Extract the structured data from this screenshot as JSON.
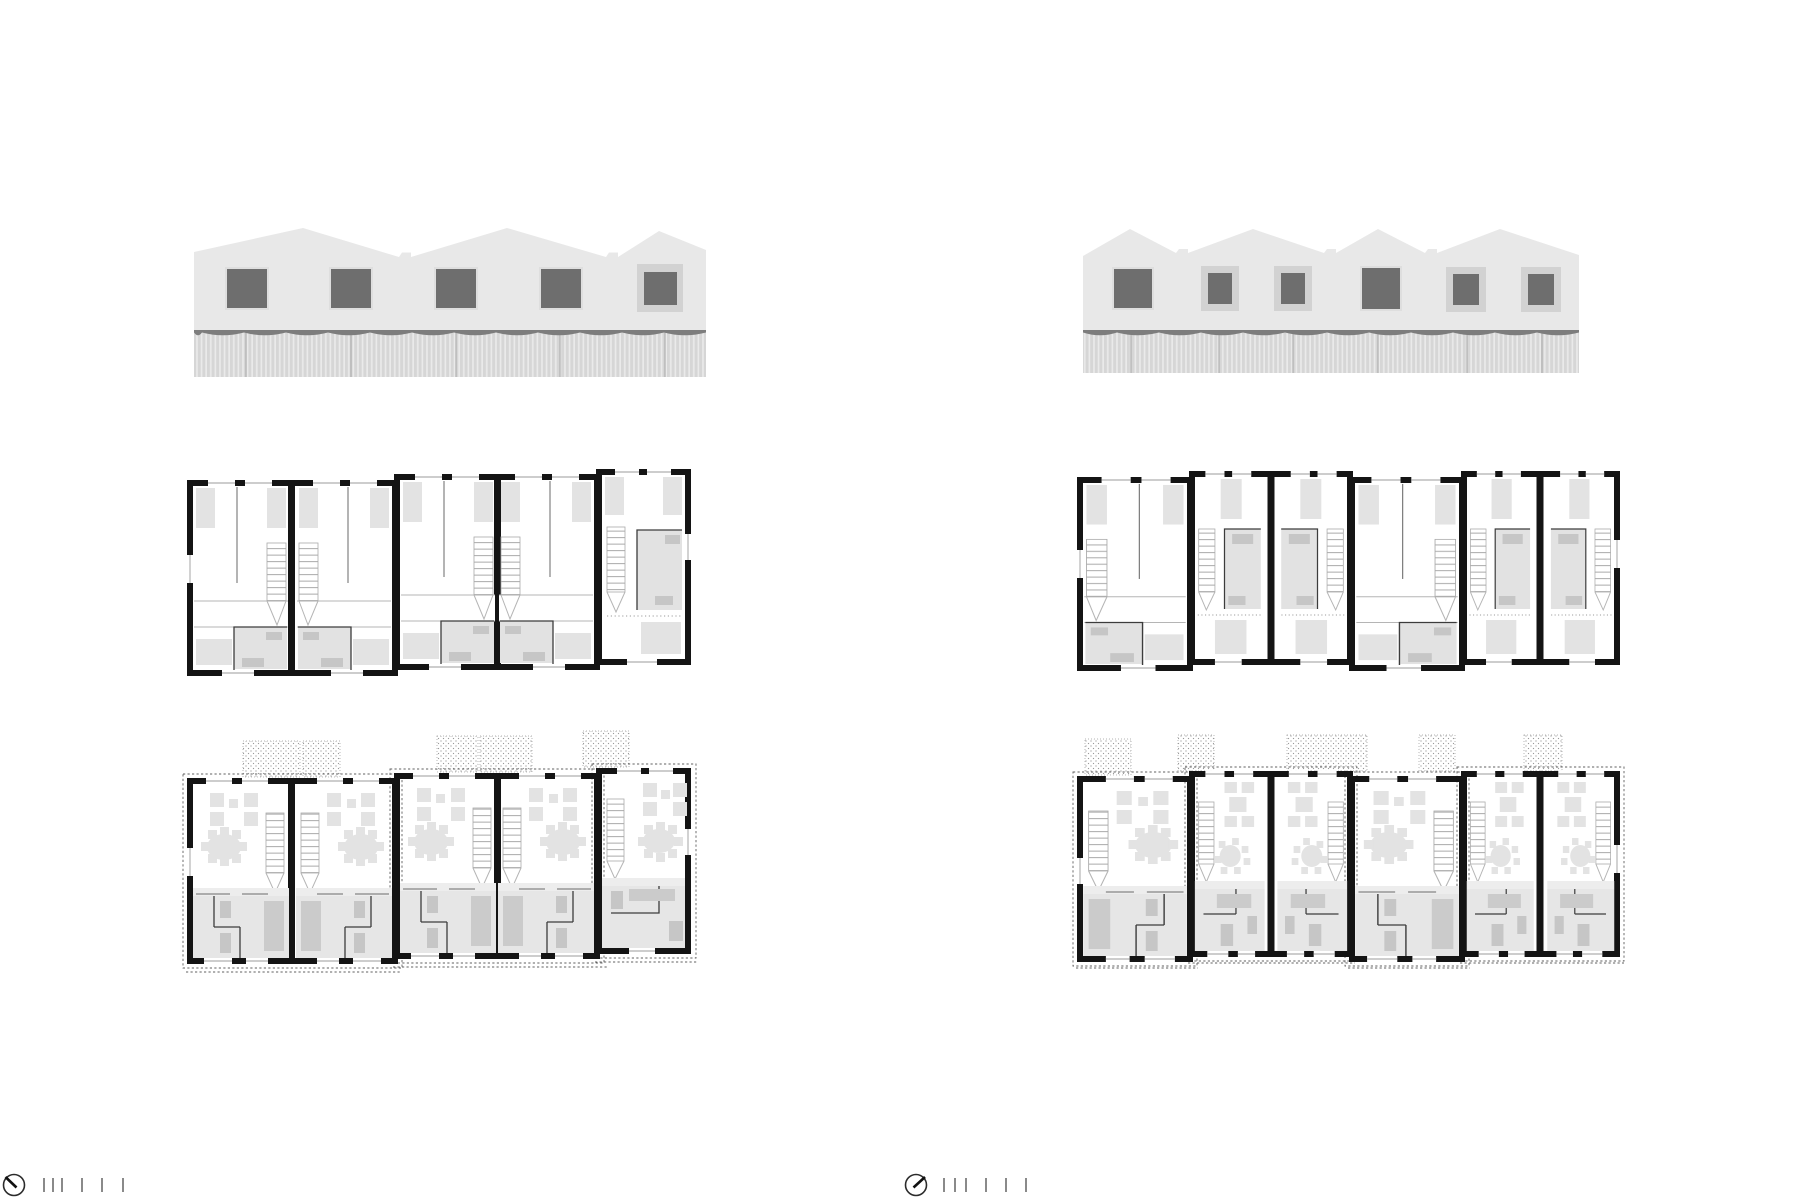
{
  "sheet": {
    "title": "Terraced housing — elevations and floor plans",
    "left_figure": {
      "name": "block-a",
      "elevation": {
        "label": "street elevation left block",
        "gable_peaks": 3,
        "windows": 5,
        "framed_windows": 1,
        "clad_fence": true
      },
      "upper_floor_plan": {
        "label": "upper floor plan left block",
        "units": 5,
        "unit_blocks": [
          2,
          2,
          1
        ],
        "stairs_per_unit": 1,
        "bathrooms_per_unit": 1
      },
      "ground_floor_plan": {
        "label": "ground floor plan left block",
        "units": 5,
        "terraces": 5,
        "dining_tables": 5,
        "kitchen_band": true
      }
    },
    "right_figure": {
      "name": "block-b",
      "elevation": {
        "label": "street elevation right block",
        "gable_peaks": 4,
        "windows": 6,
        "framed_windows": 4,
        "clad_fence": true
      },
      "upper_floor_plan": {
        "label": "upper floor plan right block",
        "units": 6,
        "unit_blocks": [
          1,
          2,
          1,
          2
        ],
        "stairs_per_unit": 1,
        "bathrooms_per_unit": 1
      },
      "ground_floor_plan": {
        "label": "ground floor plan right block",
        "units": 6,
        "terraces": 5,
        "dining_tables": 6,
        "kitchen_band": true
      }
    },
    "annotations": {
      "north_arrow_left": {
        "icon": "compass-circle-icon",
        "needle_direction": "up-left"
      },
      "north_arrow_right": {
        "icon": "compass-circle-icon",
        "needle_direction": "up-right"
      },
      "scale_bar": {
        "ticks": 6,
        "grouping": "three close, then three spaced"
      }
    }
  },
  "colors": {
    "background": "#ffffff",
    "facade": "#e8e8e8",
    "window_dark": "#6e6e6e",
    "window_frame": "#d2d2d2",
    "fence_slat": "#d6d6d6",
    "fence_gap": "#eaeaea",
    "fence_wave": "#7d7d7d",
    "wall": "#141414",
    "furniture": "#e3e3e3",
    "bathroom": "#e2e2e2",
    "fixture": "#c6c6c6",
    "ground_band": "#e6e6e6",
    "counter": "#cbcbcb",
    "stipple": "#9a9a9a"
  }
}
